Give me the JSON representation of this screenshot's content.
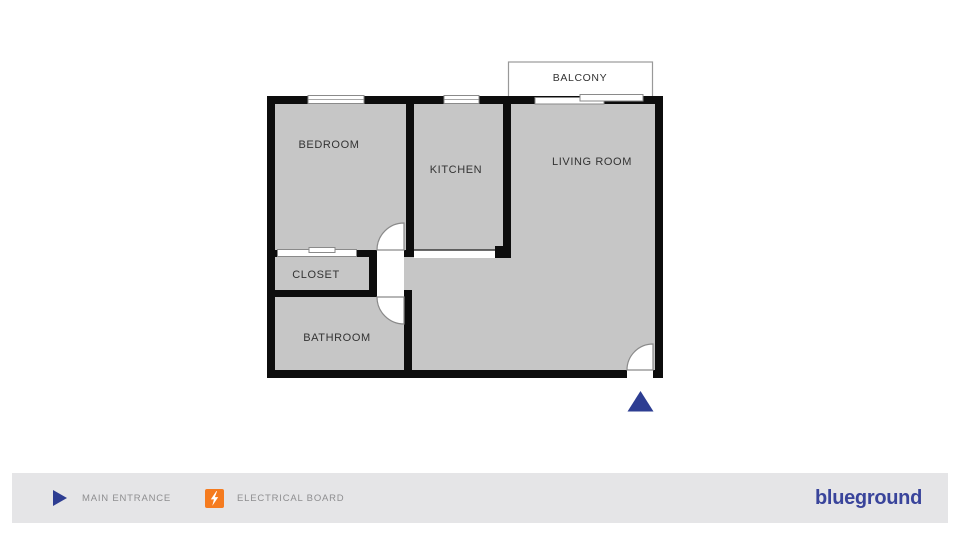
{
  "colors": {
    "wall": "#0d0d0d",
    "room_fill": "#c6c6c6",
    "room_label": "#333333",
    "door_line": "#8a8a8a",
    "entrance_navy": "#2d3d92",
    "electrical_orange": "#f57b1f",
    "brand_navy": "#39449b",
    "legend_bg": "#e5e5e7",
    "legend_text": "#8e8e90"
  },
  "plan": {
    "rooms": [
      {
        "name": "bedroom",
        "label": "BEDROOM"
      },
      {
        "name": "kitchen",
        "label": "KITCHEN"
      },
      {
        "name": "living-room",
        "label": "LIVING ROOM"
      },
      {
        "name": "closet",
        "label": "CLOSET"
      },
      {
        "name": "bathroom",
        "label": "BATHROOM"
      },
      {
        "name": "balcony",
        "label": "BALCONY"
      }
    ]
  },
  "legend": {
    "items": [
      {
        "icon": "main-entrance-icon",
        "label": "MAIN ENTRANCE"
      },
      {
        "icon": "electrical-board-icon",
        "label": "ELECTRICAL BOARD"
      }
    ],
    "brand": "blueground"
  }
}
